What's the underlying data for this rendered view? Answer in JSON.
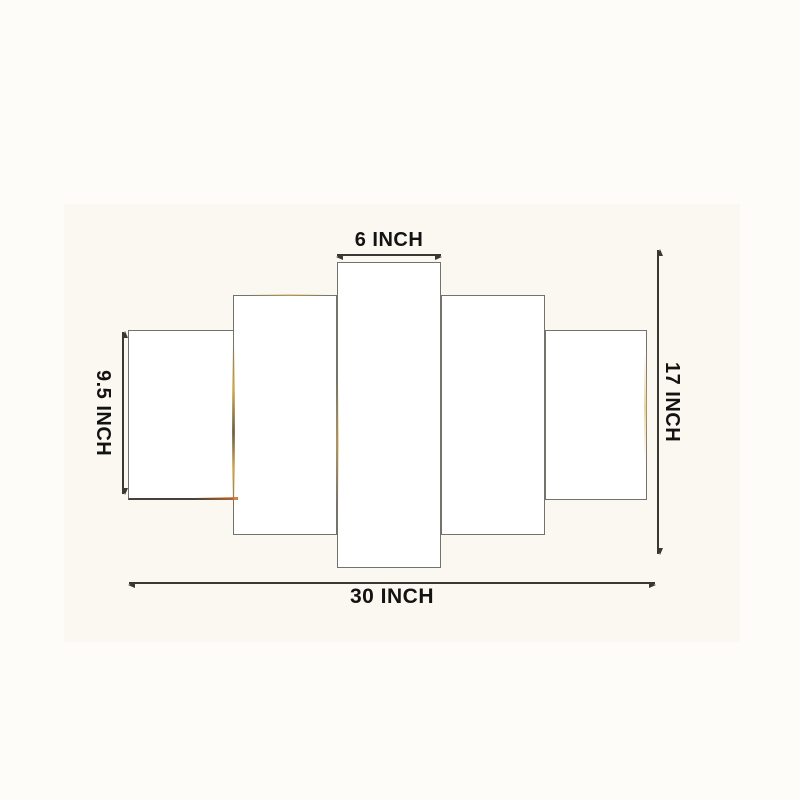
{
  "figure": {
    "type": "wall-art-panel-size-diagram",
    "panel_count": 5,
    "panels": [
      {
        "name": "left-outer-panel"
      },
      {
        "name": "left-inner-panel"
      },
      {
        "name": "center-panel"
      },
      {
        "name": "right-inner-panel"
      },
      {
        "name": "right-outer-panel"
      }
    ],
    "labels": {
      "top": "6 INCH",
      "left": "9.5 INCH",
      "right": "17 INCH",
      "bottom": "30 INCH"
    },
    "dimensions": {
      "unit": "INCH",
      "center_panel_width": 6,
      "outer_panel_height": 9.5,
      "total_height": 17,
      "total_width": 30
    },
    "colors": {
      "page_background": "#fdfcf9",
      "figure_background": "#faf8f0",
      "panel_fill": "#ffffff",
      "panel_border": "#74726c",
      "dimension_line": "#3a3834",
      "label_text": "#131313",
      "glint_gold": "#d9b25f",
      "glint_orange": "#c96f2e",
      "glint_shadow": "#6a5a3a"
    }
  }
}
